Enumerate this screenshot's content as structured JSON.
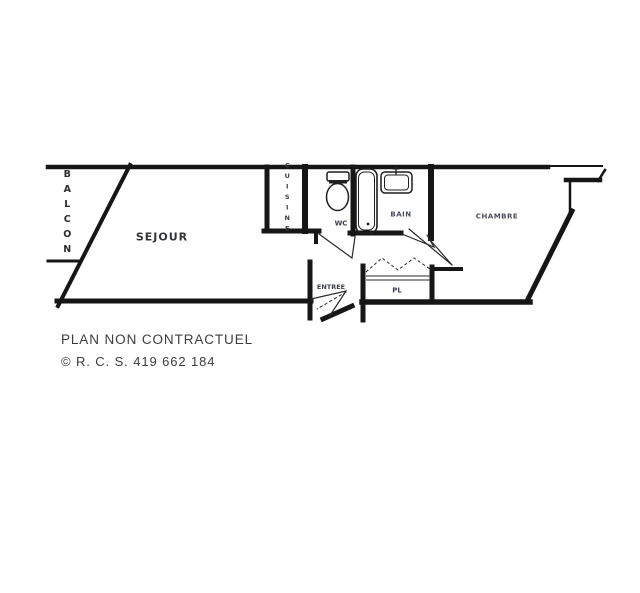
{
  "plan": {
    "rooms": {
      "balcon": "BALCON",
      "sejour": "SEJOUR",
      "cuisine": "CUISINE",
      "wc": "WC",
      "bain": "BAIN",
      "chambre": "CHAMBRE",
      "entree": "ENTREE",
      "placard": "PL"
    },
    "colors": {
      "wall": "#161616",
      "label": "#3c3f49",
      "label_muted": "#4a4e5a"
    }
  },
  "footer": {
    "disclaimer": "PLAN NON CONTRACTUEL",
    "copyright": "© R. C. S. 419 662 184"
  }
}
